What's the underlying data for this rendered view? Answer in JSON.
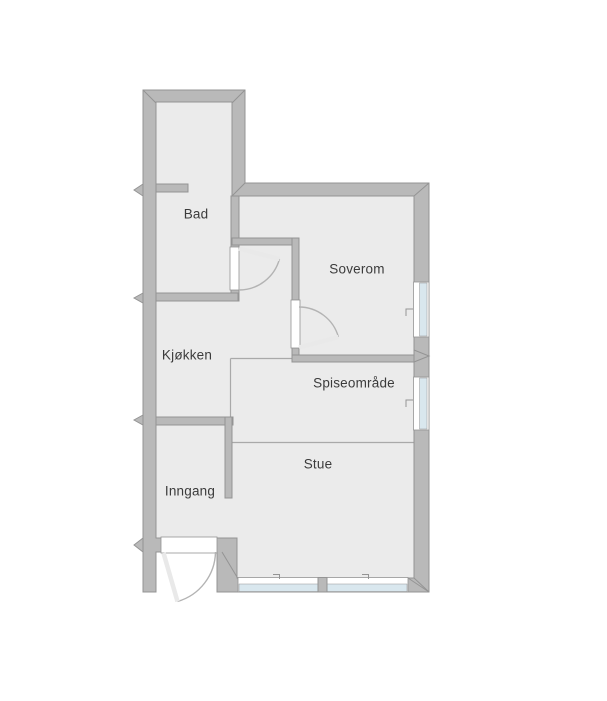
{
  "rooms": [
    {
      "id": "bad",
      "label": "Bad"
    },
    {
      "id": "soverom",
      "label": "Soverom"
    },
    {
      "id": "kjokken",
      "label": "Kjøkken"
    },
    {
      "id": "spiseomrade",
      "label": "Spiseområde"
    },
    {
      "id": "stue",
      "label": "Stue"
    },
    {
      "id": "inngang",
      "label": "Inngang"
    }
  ],
  "colors": {
    "wall_fill": "#b9b9b9",
    "wall_outline": "#949494",
    "floor": "#ebebeb",
    "floor_outline": "#a6a6a6",
    "window_glass": "#d9e7ee",
    "door_arc": "#b3b3b3",
    "door_leaf": "#e9e9e9",
    "open_boundary_line": "#a9a9a9",
    "label_text": "#3b3b3b",
    "background": "#ffffff"
  }
}
